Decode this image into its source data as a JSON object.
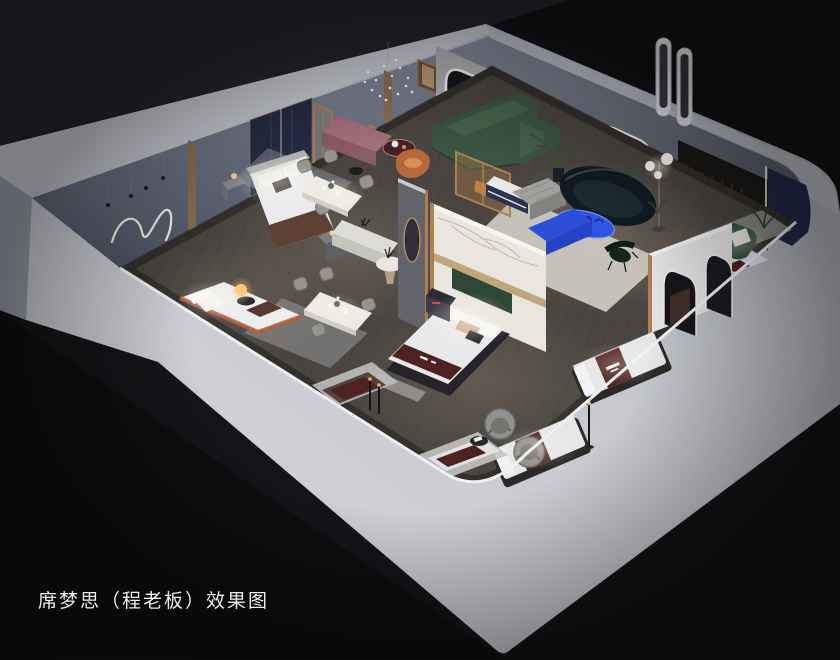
{
  "caption": {
    "text": "席梦思（程老板）效果图"
  },
  "colors": {
    "background": "#141418",
    "bg_top_left": "#23252c",
    "bg_top_right": "#111114",
    "wall_light": "#d5d6da",
    "floor_wood": "#4a4540",
    "sofa_green": "#3a5540",
    "sofa_teal": "#101b20",
    "table_blue": "#2e55e3",
    "bench_blue": "#2b4fd8",
    "runner_maroon": "#4e2220",
    "navy_wall": "#262c44",
    "navy_corner": "#232a4b",
    "marble": "#e9e6df",
    "bench_pink": "#a4707c",
    "chair_orange": "#b4683c",
    "gold_trim": "#ab8154",
    "led_white": "#f7f4ec"
  }
}
